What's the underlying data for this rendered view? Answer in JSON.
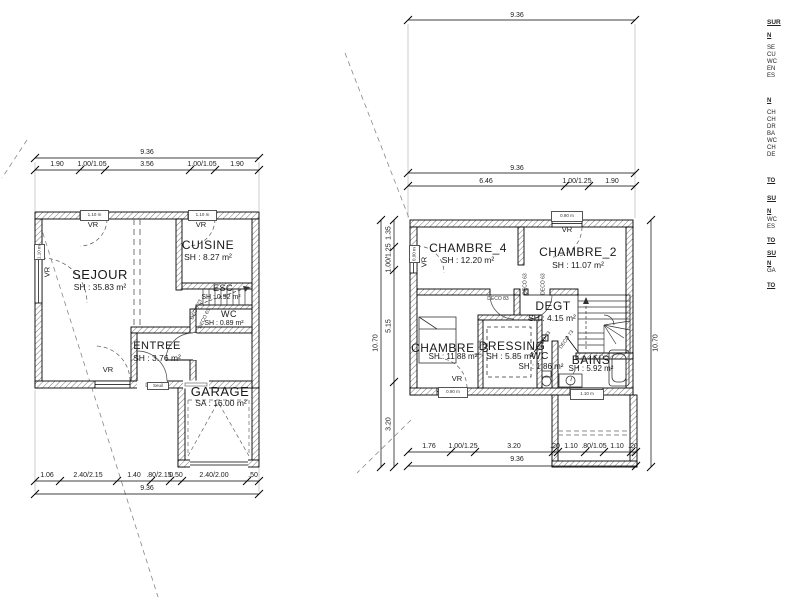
{
  "ground_floor": {
    "dim_top_total": "9.36",
    "dim_top_segments": [
      "1.90",
      "1.00/1.05",
      "3.56",
      "1.00/1.05",
      "1.90"
    ],
    "dim_bottom_segments": [
      "1.06",
      "2.40/2.15",
      "1.40",
      ".80/2.15",
      "0.50",
      "2.40/2.00",
      ".50"
    ],
    "dim_bottom_total": "9.36",
    "rooms": {
      "sejour": {
        "name": "SEJOUR",
        "area": "SH : 35.83 m²"
      },
      "cuisine": {
        "name": "CUISINE",
        "area": "SH : 8.27 m²"
      },
      "esc": {
        "name": "ESC",
        "area": "SH : 0.92 m²"
      },
      "wc": {
        "name": "WC",
        "area": "SH : 0.89 m²"
      },
      "entree": {
        "name": "ENTREE",
        "area": "SH : 3.76 m²"
      },
      "garage": {
        "name": "GARAGE",
        "area": "SA : 16.00 m²"
      }
    },
    "vr_label": "VR",
    "door_tags": [
      "DECO 73",
      "DECO 63"
    ],
    "sill_tags": [
      "1.10 m",
      "1.10 m",
      "1.10 m",
      "Seuil"
    ]
  },
  "upper_floor": {
    "dim_top_total": "9.36",
    "dim_mid_total": "9.36",
    "dim_mid_segments": [
      "6.46",
      "1.00/1.25",
      "1.90"
    ],
    "dim_bottom_segments": [
      "1.76",
      "1.00/1.25",
      "3.20",
      ".20",
      "1.10",
      ".80/1.05",
      "1.10",
      ".20"
    ],
    "dim_bottom_total": "9.36",
    "dim_left_segments": [
      "1.35",
      "1.00/1.25",
      "5.15",
      "3.20"
    ],
    "dim_left_total": "10.70",
    "dim_right_total": "10.70",
    "rooms": {
      "chambre4": {
        "name": "CHAMBRE_4",
        "area": "SH : 12.20 m²"
      },
      "chambre2": {
        "name": "CHAMBRE_2",
        "area": "SH : 11.07 m²"
      },
      "chambre3": {
        "name": "CHAMBRE_3",
        "area": "SH : 11.88 m²"
      },
      "dressing": {
        "name": "DRESSING",
        "area": "SH : 5.85 m²"
      },
      "wc": {
        "name": "WC",
        "area": "SH : 1.86 m²"
      },
      "bains": {
        "name": "BAINS",
        "area": "SH : 5.92 m²"
      },
      "degt": {
        "name": "DEGT",
        "area": "SH : 4.15 m²"
      }
    },
    "vr_label": "VR",
    "door_tags": [
      "DECO 83",
      "DECO 63",
      "DECO 63",
      "DECO 73",
      "DECO 73"
    ],
    "sill_tags": [
      "0.90 m",
      "0.90 m",
      "0.90 m",
      "1.10 m"
    ]
  },
  "legend": {
    "lines": [
      {
        "y": 20,
        "t": "SUR",
        "s": "h1"
      },
      {
        "y": 33,
        "t": "N",
        "s": "h2"
      },
      {
        "y": 45,
        "t": "SE",
        "s": ""
      },
      {
        "y": 52,
        "t": "CU",
        "s": ""
      },
      {
        "y": 59,
        "t": "WC",
        "s": ""
      },
      {
        "y": 66,
        "t": "EN",
        "s": ""
      },
      {
        "y": 73,
        "t": "ES",
        "s": ""
      },
      {
        "y": 98,
        "t": "N",
        "s": "h2"
      },
      {
        "y": 110,
        "t": "CH",
        "s": ""
      },
      {
        "y": 117,
        "t": "CH",
        "s": ""
      },
      {
        "y": 124,
        "t": "DR",
        "s": ""
      },
      {
        "y": 131,
        "t": "BA",
        "s": ""
      },
      {
        "y": 138,
        "t": "WC",
        "s": ""
      },
      {
        "y": 145,
        "t": "CH",
        "s": ""
      },
      {
        "y": 152,
        "t": "DE",
        "s": ""
      },
      {
        "y": 178,
        "t": "TO",
        "s": "h2"
      },
      {
        "y": 196,
        "t": "SU",
        "s": "h1"
      },
      {
        "y": 209,
        "t": "N",
        "s": "h2"
      },
      {
        "y": 217,
        "t": "WC",
        "s": ""
      },
      {
        "y": 224,
        "t": "ES",
        "s": ""
      },
      {
        "y": 238,
        "t": "TO",
        "s": "h2"
      },
      {
        "y": 251,
        "t": "SU",
        "s": "h1"
      },
      {
        "y": 261,
        "t": "N",
        "s": "h2"
      },
      {
        "y": 268,
        "t": "GA",
        "s": ""
      },
      {
        "y": 283,
        "t": "TO",
        "s": "h2"
      }
    ]
  }
}
